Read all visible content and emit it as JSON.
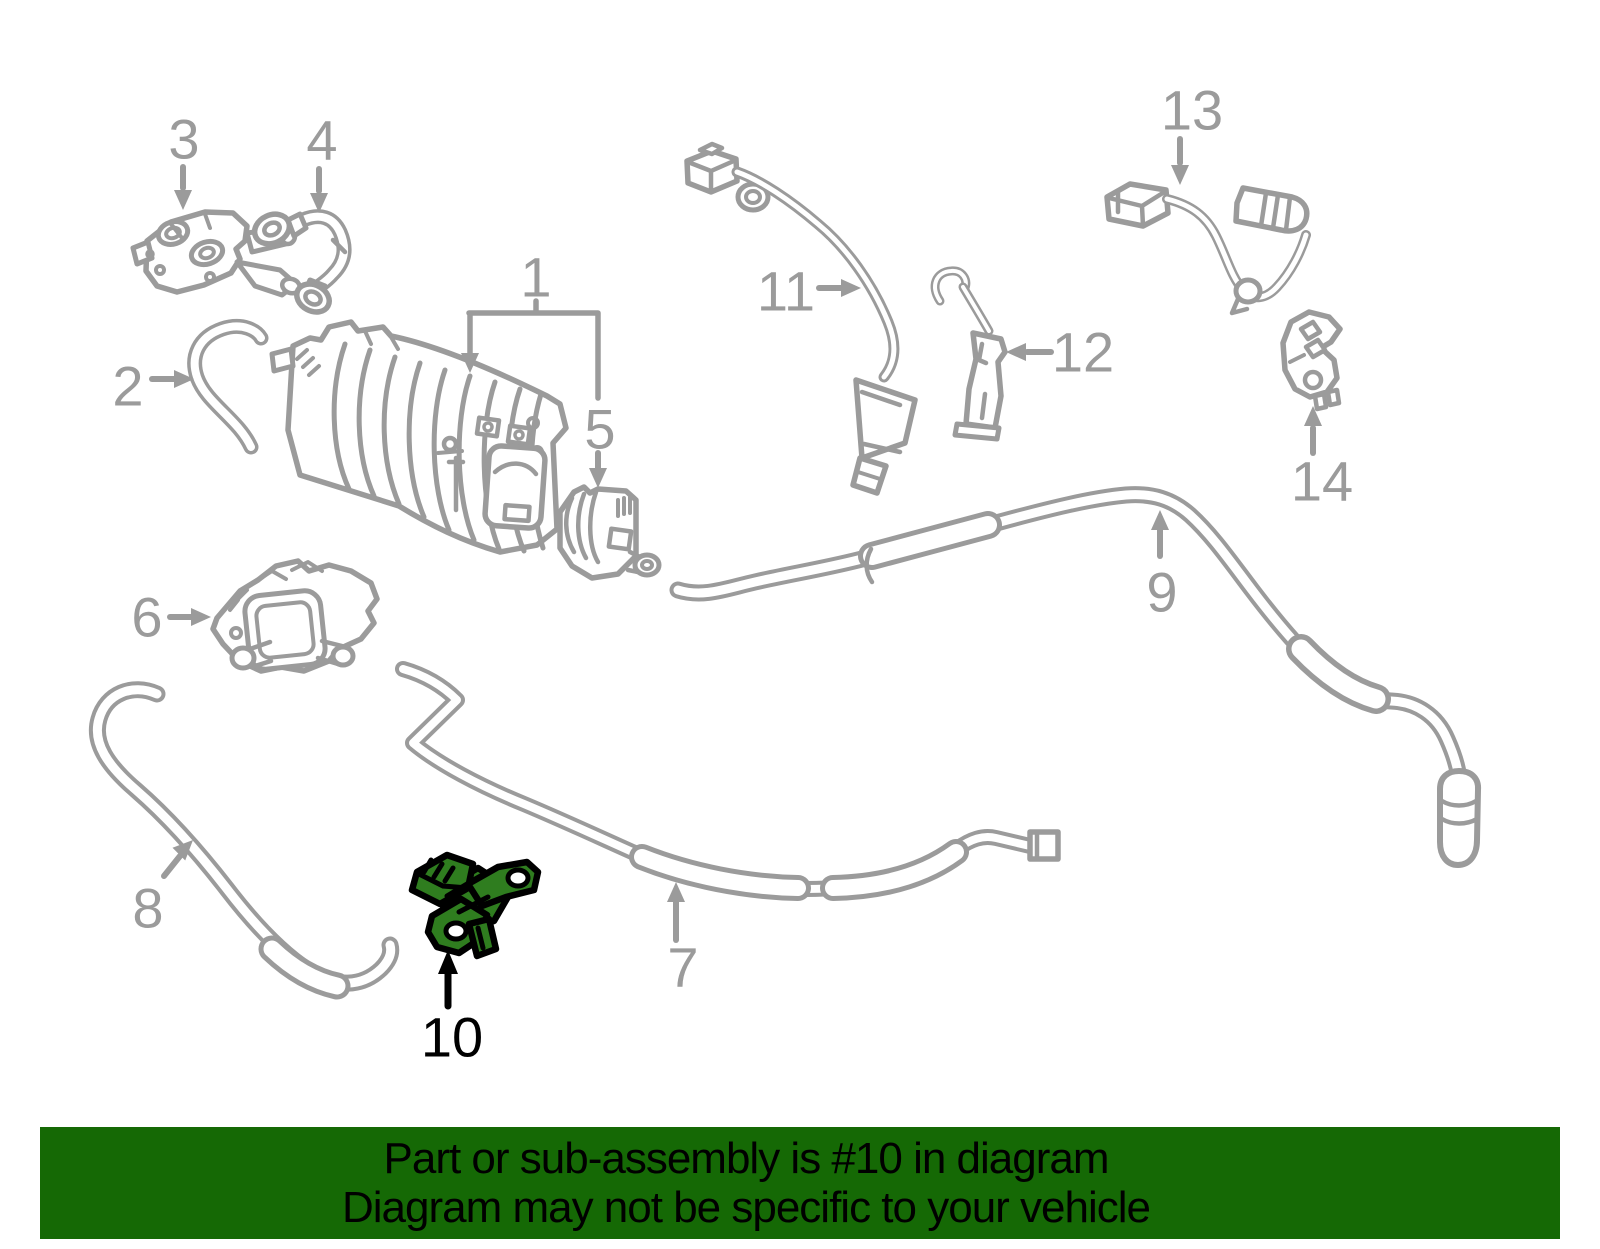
{
  "callouts": [
    "1",
    "2",
    "3",
    "4",
    "5",
    "6",
    "7",
    "8",
    "9",
    "10",
    "11",
    "12",
    "13",
    "14"
  ],
  "highlighted_callout": "10",
  "banner": {
    "line1": "Part or sub-assembly is #10 in diagram",
    "line2": "Diagram may not be specific to your vehicle"
  },
  "colors": {
    "line": "#9b9b9b",
    "label": "#9b9b9b",
    "label_highlight": "#000000",
    "highlight": "#2f7d1f",
    "highlight_outline": "#000000",
    "banner_bg": "#156905",
    "banner_text": "#000000"
  }
}
